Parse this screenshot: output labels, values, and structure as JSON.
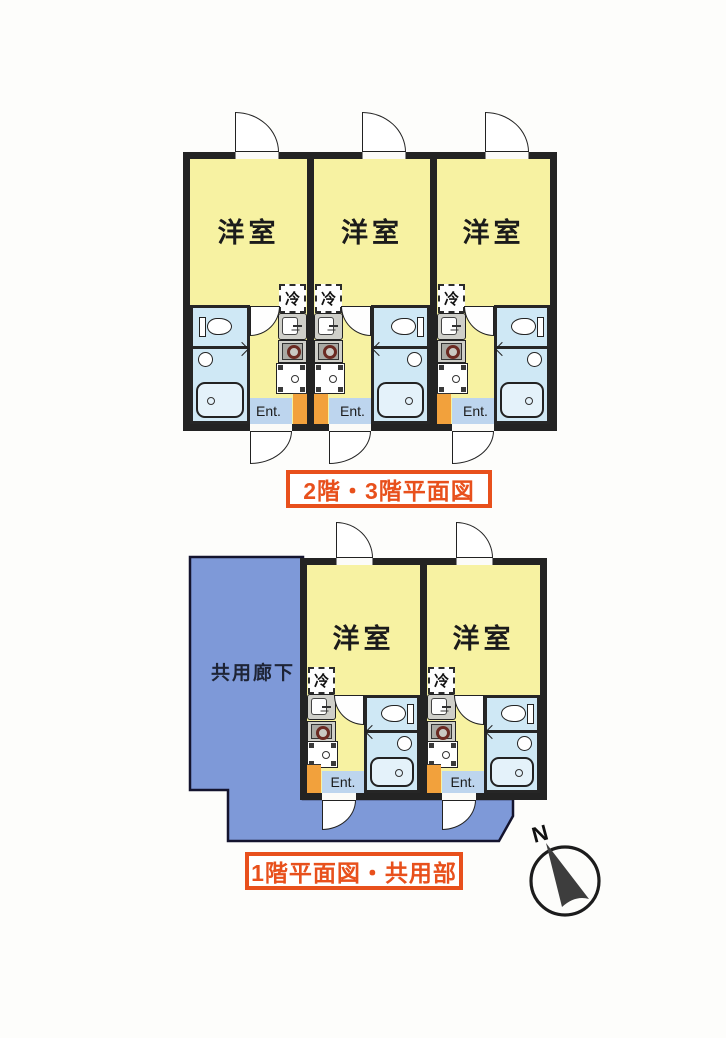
{
  "colors": {
    "room_yellow": "#f7f2a2",
    "wet_blue": "#cfe8f5",
    "corridor_blue": "#7e99d8",
    "entrance_orange": "#f2a13c",
    "ent_strip_blue": "#bdd5ee",
    "wall": "#232323",
    "caption_red": "#e8501c",
    "tub_fill": "#e4f2fa"
  },
  "plans": {
    "upper": {
      "caption": "2階・3階平面図",
      "units": [
        {
          "room_label": "洋室",
          "fridge_label": "冷",
          "entrance_label": "Ent."
        },
        {
          "room_label": "洋室",
          "fridge_label": "冷",
          "entrance_label": "Ent."
        },
        {
          "room_label": "洋室",
          "fridge_label": "冷",
          "entrance_label": "Ent."
        }
      ]
    },
    "lower": {
      "caption": "1階平面図・共用部",
      "corridor_label": "共用廊下",
      "units": [
        {
          "room_label": "洋室",
          "fridge_label": "冷",
          "entrance_label": "Ent."
        },
        {
          "room_label": "洋室",
          "fridge_label": "冷",
          "entrance_label": "Ent."
        }
      ]
    }
  },
  "compass": {
    "north_label": "N"
  }
}
